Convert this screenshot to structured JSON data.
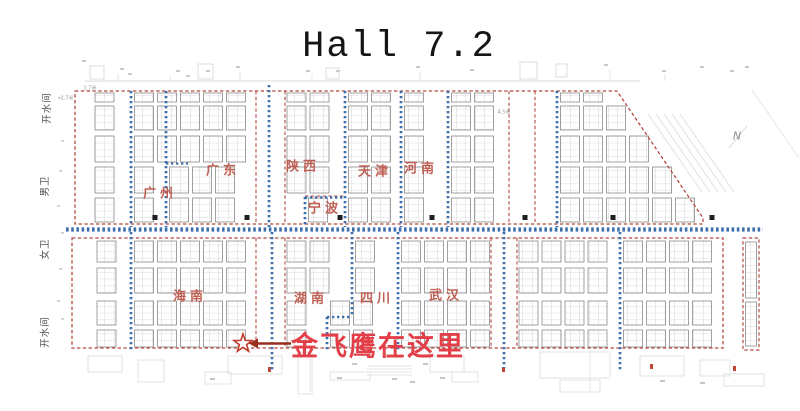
{
  "title": "Hall 7.2",
  "compass_label": "N",
  "annotation": {
    "text": "金飞鹰在这里"
  },
  "regions": [
    {
      "name": "广州",
      "x": 160,
      "y": 192
    },
    {
      "name": "广东",
      "x": 223,
      "y": 169
    },
    {
      "name": "陕西",
      "x": 303,
      "y": 165
    },
    {
      "name": "天津",
      "x": 375,
      "y": 170
    },
    {
      "name": "河南",
      "x": 421,
      "y": 167
    },
    {
      "name": "宁波",
      "x": 325,
      "y": 207
    },
    {
      "name": "海南",
      "x": 190,
      "y": 295
    },
    {
      "name": "湖南",
      "x": 311,
      "y": 297
    },
    {
      "name": "四川",
      "x": 377,
      "y": 297
    },
    {
      "name": "武汉",
      "x": 446,
      "y": 294
    }
  ],
  "facilities": [
    {
      "name": "开水间",
      "x": 46,
      "y": 108
    },
    {
      "name": "男卫",
      "x": 44,
      "y": 186
    },
    {
      "name": "女卫",
      "x": 44,
      "y": 249
    },
    {
      "name": "开水间",
      "x": 44,
      "y": 332
    }
  ],
  "dim_labels": [
    {
      "text": "1.7米",
      "x": 90,
      "y": 88
    },
    {
      "text": "1.7米",
      "x": 67,
      "y": 98
    },
    {
      "text": "4.5米",
      "x": 504,
      "y": 112
    }
  ],
  "colors": {
    "boundary_red": "#b5493f",
    "aisle_blue": "#3d6fae",
    "region_label": "#bc574a",
    "annotation_red": "#e23f48",
    "arrow_red": "#9b2d1f",
    "star_red": "#c23a2c",
    "booth_gray": "#7a7a7a",
    "cell_gray": "#bcbcbc",
    "pillar_black": "#1f1f1f",
    "faint_gray": "#d8d8d8"
  }
}
